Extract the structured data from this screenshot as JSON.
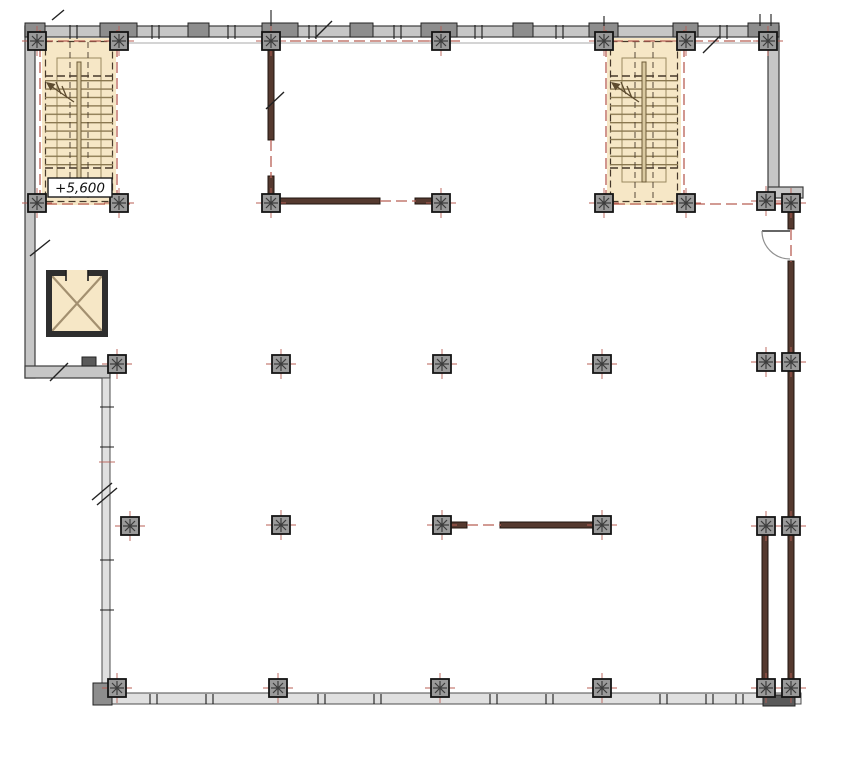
{
  "drawing": {
    "level_label": "+5,600",
    "colors": {
      "background": "#ffffff",
      "exterior_wall_fill": "#c6c6c6",
      "exterior_wall_stroke": "#3c3c3c",
      "pier_fill": "#8d8d8d",
      "curtain_wall_fill": "#e0e0e0",
      "column_fill": "#9a9a9a",
      "column_stroke": "#141414",
      "interior_wall_fill": "#55392f",
      "interior_wall_stroke": "#20150f",
      "stair_fill": "#f6e7c6",
      "stair_line": "#8a7850",
      "stair_dash": "#46392a",
      "centerline_red": "#b85f55",
      "elevator_wall": "#2e2e2e",
      "elevator_cross": "#a39070",
      "door_arc": "#8f8f8f",
      "tick_dark": "#1c1c1c",
      "label_text": "#111111"
    }
  }
}
